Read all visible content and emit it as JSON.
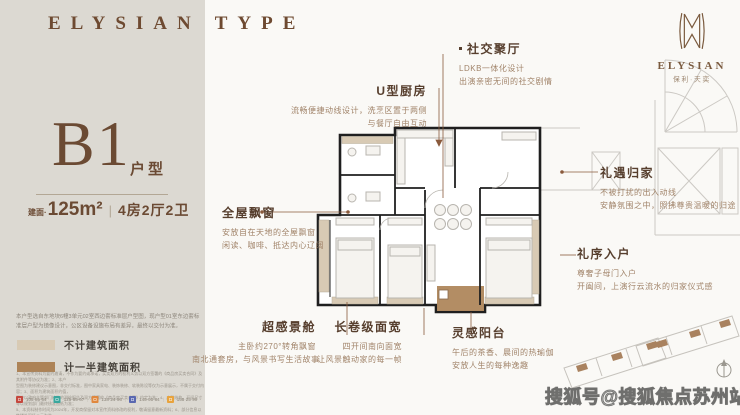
{
  "brand": {
    "left": "ELYSIAN",
    "right": "TYPE"
  },
  "unit": {
    "code": "B1",
    "type_label": "户型",
    "area_prefix": "建面·",
    "area_value": "125m²",
    "separator": "|",
    "layout": "4房2厅2卫"
  },
  "panel": {
    "note": "本户型选自东地块6幢3单元02室西边套标准层户型图，现户型01室东边套标准层户型为镜像设计，公区设备设施布局有差异，最终以交付为准。",
    "legend": [
      {
        "label": "不计建筑面积",
        "color": "#d8cab4"
      },
      {
        "label": "计一半建筑面积",
        "color": "#ad8357"
      }
    ],
    "fine_print": {
      "l1": "1、本宣传资料为要约邀请，不作为要约或承诺，买卖双方的权利义务以双方签署的《商品房买卖合同》及其附件等协议为准；2、本户",
      "l2": "型图为装修建议示意图，非交付标准，图中家具家电、装饰装修、软装陈设等仅为示意展示，不属于交付内容；3、面积为建筑面积约值，",
      "l3": "最终以政府主管部门核准的测绘报告及双方签署的《商品房买卖合同》约定为准；4、户型结构、开间尺寸等以规划部门最终核准图纸为准；",
      "l4": "5、本资料制作时间为2024年，开发商保留对本宣传资料修改的权利，敬请留意最新资料；6、部分信息以售楼处现场公示为准。"
    },
    "social_chips": [
      {
        "color": "#c5483e",
        "label": "105·85·64"
      },
      {
        "color": "#3aa79d",
        "label": "125·85·67"
      },
      {
        "color": "#e0883e",
        "label": "138·24·96"
      },
      {
        "color": "#5a68b0",
        "label": "145·95·84"
      },
      {
        "color": "#e8a33d",
        "label": "158·25·99"
      }
    ],
    "separator": "|"
  },
  "annotations": {
    "social_hall": {
      "title": "社交聚厅",
      "line1": "LDKB一体化设计",
      "line2": "出演亲密无间的社交剧情"
    },
    "kitchen": {
      "title": "U型厨房",
      "line1": "流畅便捷动线设计，洗烹区置于两侧",
      "line2": "与餐厅自由互动"
    },
    "bay_window": {
      "title": "全屋飘窗",
      "line1": "安放自在天地的全屋飘窗",
      "line2": "闲读、咖啡、抵达内心辽阔"
    },
    "view_pod": {
      "title": "超感景舱",
      "line1": "主卧约270°转角飘窗",
      "line2": "南北通套房，与风景书写生活故事"
    },
    "frontage": {
      "title": "长卷级面宽",
      "line1": "四开间南向面宽",
      "line2": "让风景触动家的每一帧"
    },
    "balcony": {
      "title": "灵感阳台",
      "line1": "午后的茶香、晨间的热瑜伽",
      "line2": "安放人生的每种逸趣"
    },
    "homecoming": {
      "title": "礼遇归家",
      "line1": "不被打扰的出入动线",
      "line2": "安静氛围之中，照拂尊贵温暖的归途"
    },
    "entry": {
      "title": "礼序入户",
      "line1": "尊奢子母门入户",
      "line2": "开阖间，上演行云流水的归家仪式感"
    }
  },
  "logo": {
    "name": "ELYSIAN",
    "cn": "保利·天奕"
  },
  "watermark": {
    "text": "搜狐号@搜狐焦点苏州站"
  },
  "colors": {
    "brand_brown": "#6e4a31",
    "leader_line": "#8a5a3c",
    "balcony_fill": "#ad8357",
    "bay_fill": "#d8cab4",
    "panel_bg": "#dcd9d2"
  }
}
